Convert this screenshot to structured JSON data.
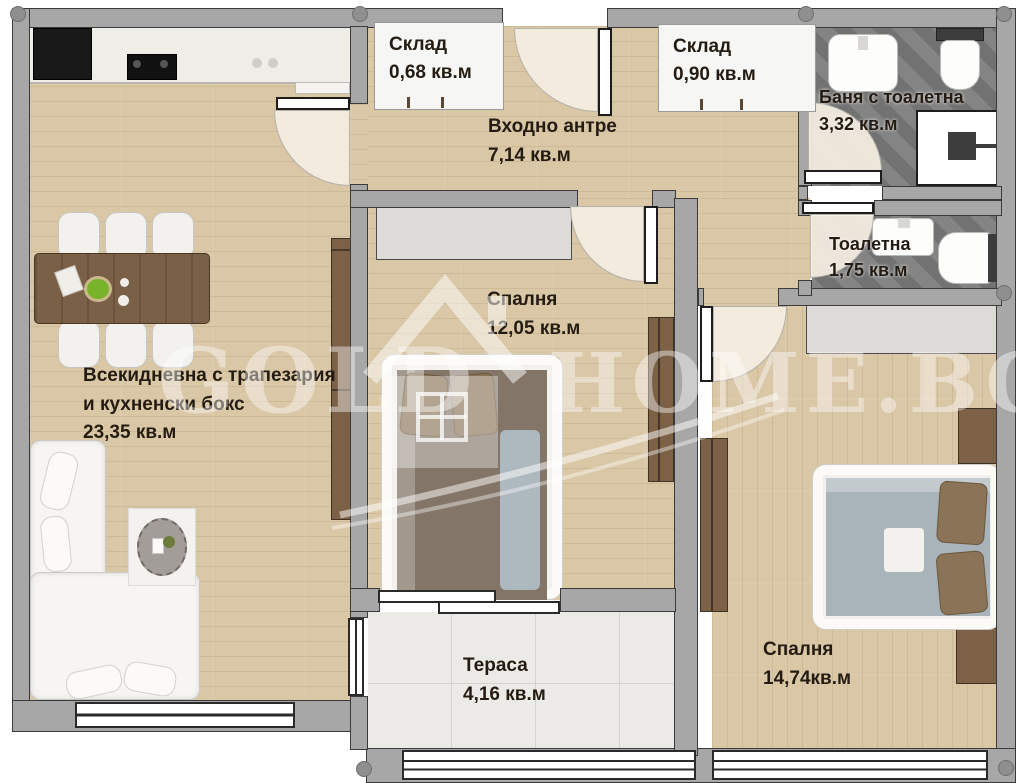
{
  "watermark": {
    "word_left": "GOLD",
    "word_right": "HOME.BG"
  },
  "rooms": {
    "living": {
      "line1": "Всекидневна с трапезария",
      "line2": "и кухненски бокс",
      "area": "23,35 кв.м"
    },
    "entry": {
      "name": "Входно антре",
      "area": "7,14 кв.м"
    },
    "storage_small": {
      "name": "Склад",
      "area": "0,68 кв.м"
    },
    "storage_large": {
      "name": "Склад",
      "area": "0,90 кв.м"
    },
    "bathroom": {
      "name": "Баня с тоалетна",
      "area": "3,32 кв.м"
    },
    "wc": {
      "name": "Тоалетна",
      "area": "1,75 кв.м"
    },
    "bedroom1": {
      "name": "Спалня",
      "area": "12,05 кв.м"
    },
    "bedroom2": {
      "name": "Спалня",
      "area": "14,74кв.м"
    },
    "terrace": {
      "name": "Тераса",
      "area": "4,16 кв.м"
    }
  },
  "colors": {
    "floor_wood": "#d9c7a6",
    "wall_fill": "#a7a7a7",
    "wall_outline": "#3a3a3a",
    "bath_tile": "#7b7b7b",
    "terrace_tile": "#ebeae6",
    "label_text": "#241c12",
    "watermark_white": "rgba(255,255,255,0.42)"
  }
}
